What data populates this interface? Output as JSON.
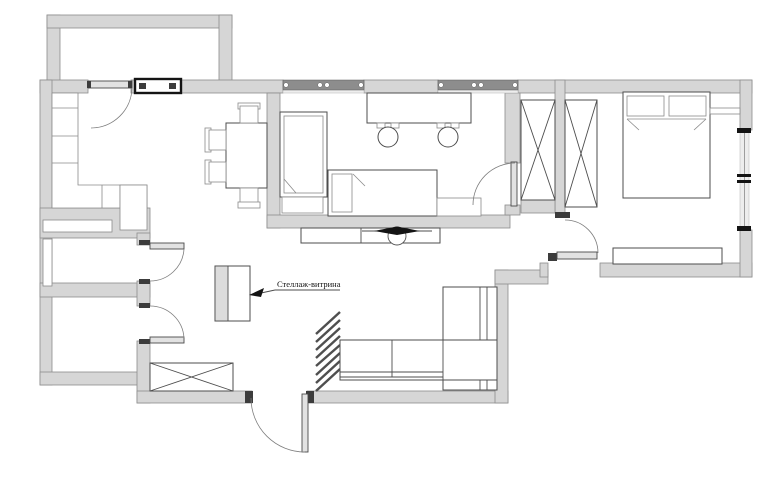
{
  "annotation": {
    "label": "Стеллаж-витрина"
  },
  "colors": {
    "page_bg": "#ffffff",
    "wall_fill": "#d6d6d6",
    "wall_stroke": "#8c8c8c",
    "line": "#4d4d4d",
    "line_light": "#8a8a8a",
    "window_band": "#8d8d8d",
    "dark": "#141414",
    "leaf_fill": "#e2e2e2",
    "label_color": "#111111"
  }
}
